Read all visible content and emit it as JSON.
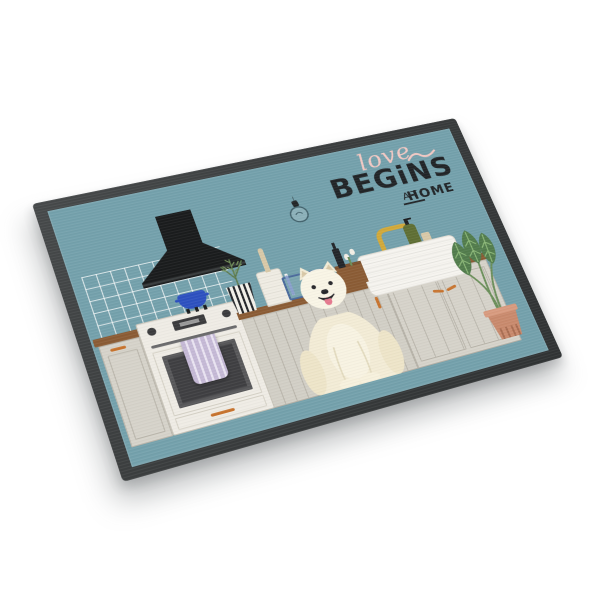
{
  "image": {
    "kind": "product photo",
    "subject": "Rectangular indoor doormat shown at an angle on a white background, printed with a flat-style kitchen scene and a white Samoyed dog",
    "background_color": "#ffffff"
  },
  "mat": {
    "border_color": "#3a3d3e",
    "surface_color": "#74a1ac",
    "headline": {
      "script_word": "love",
      "main_word": "BEGiNS",
      "sub_prefix": "AT",
      "sub_word": "HOME",
      "script_color": "#f2c9c4",
      "text_color": "#212427"
    },
    "illustration": {
      "objects": [
        "pendant light bulb",
        "black range hood",
        "white tiled backsplash",
        "white stove with oven window",
        "lavender striped tea towel",
        "blue pot",
        "cream kitchen cabinets with wood counters and orange handles",
        "striped pot with herbs",
        "utensil canister",
        "blue wire dish rack with plates",
        "wooden crate with dark bottle and white flowers",
        "white farmhouse sink",
        "gold gooseneck faucet",
        "green soap dispenser",
        "terracotta potted plant",
        "white samoyed dog sitting"
      ],
      "colors": {
        "surface": "#74a1ac",
        "script": "#f2c9c4",
        "text": "#212427",
        "cabinet": "#d6d3ca",
        "wood": "#8b5c35",
        "handle": "#c8742f",
        "stove": "#efece5",
        "oven": "#3f3f42",
        "towel": "#c5b9d6",
        "hood": "#1a1c1d",
        "pot": "#2d51c0",
        "dogcream": "#f3ecd6",
        "tongue": "#e5798e",
        "leaf": "#527c4c",
        "terracotta": "#c98a6d",
        "faucet": "#d2a93a",
        "soap": "#5f6f34",
        "rack": "#4a6a9c"
      }
    }
  }
}
